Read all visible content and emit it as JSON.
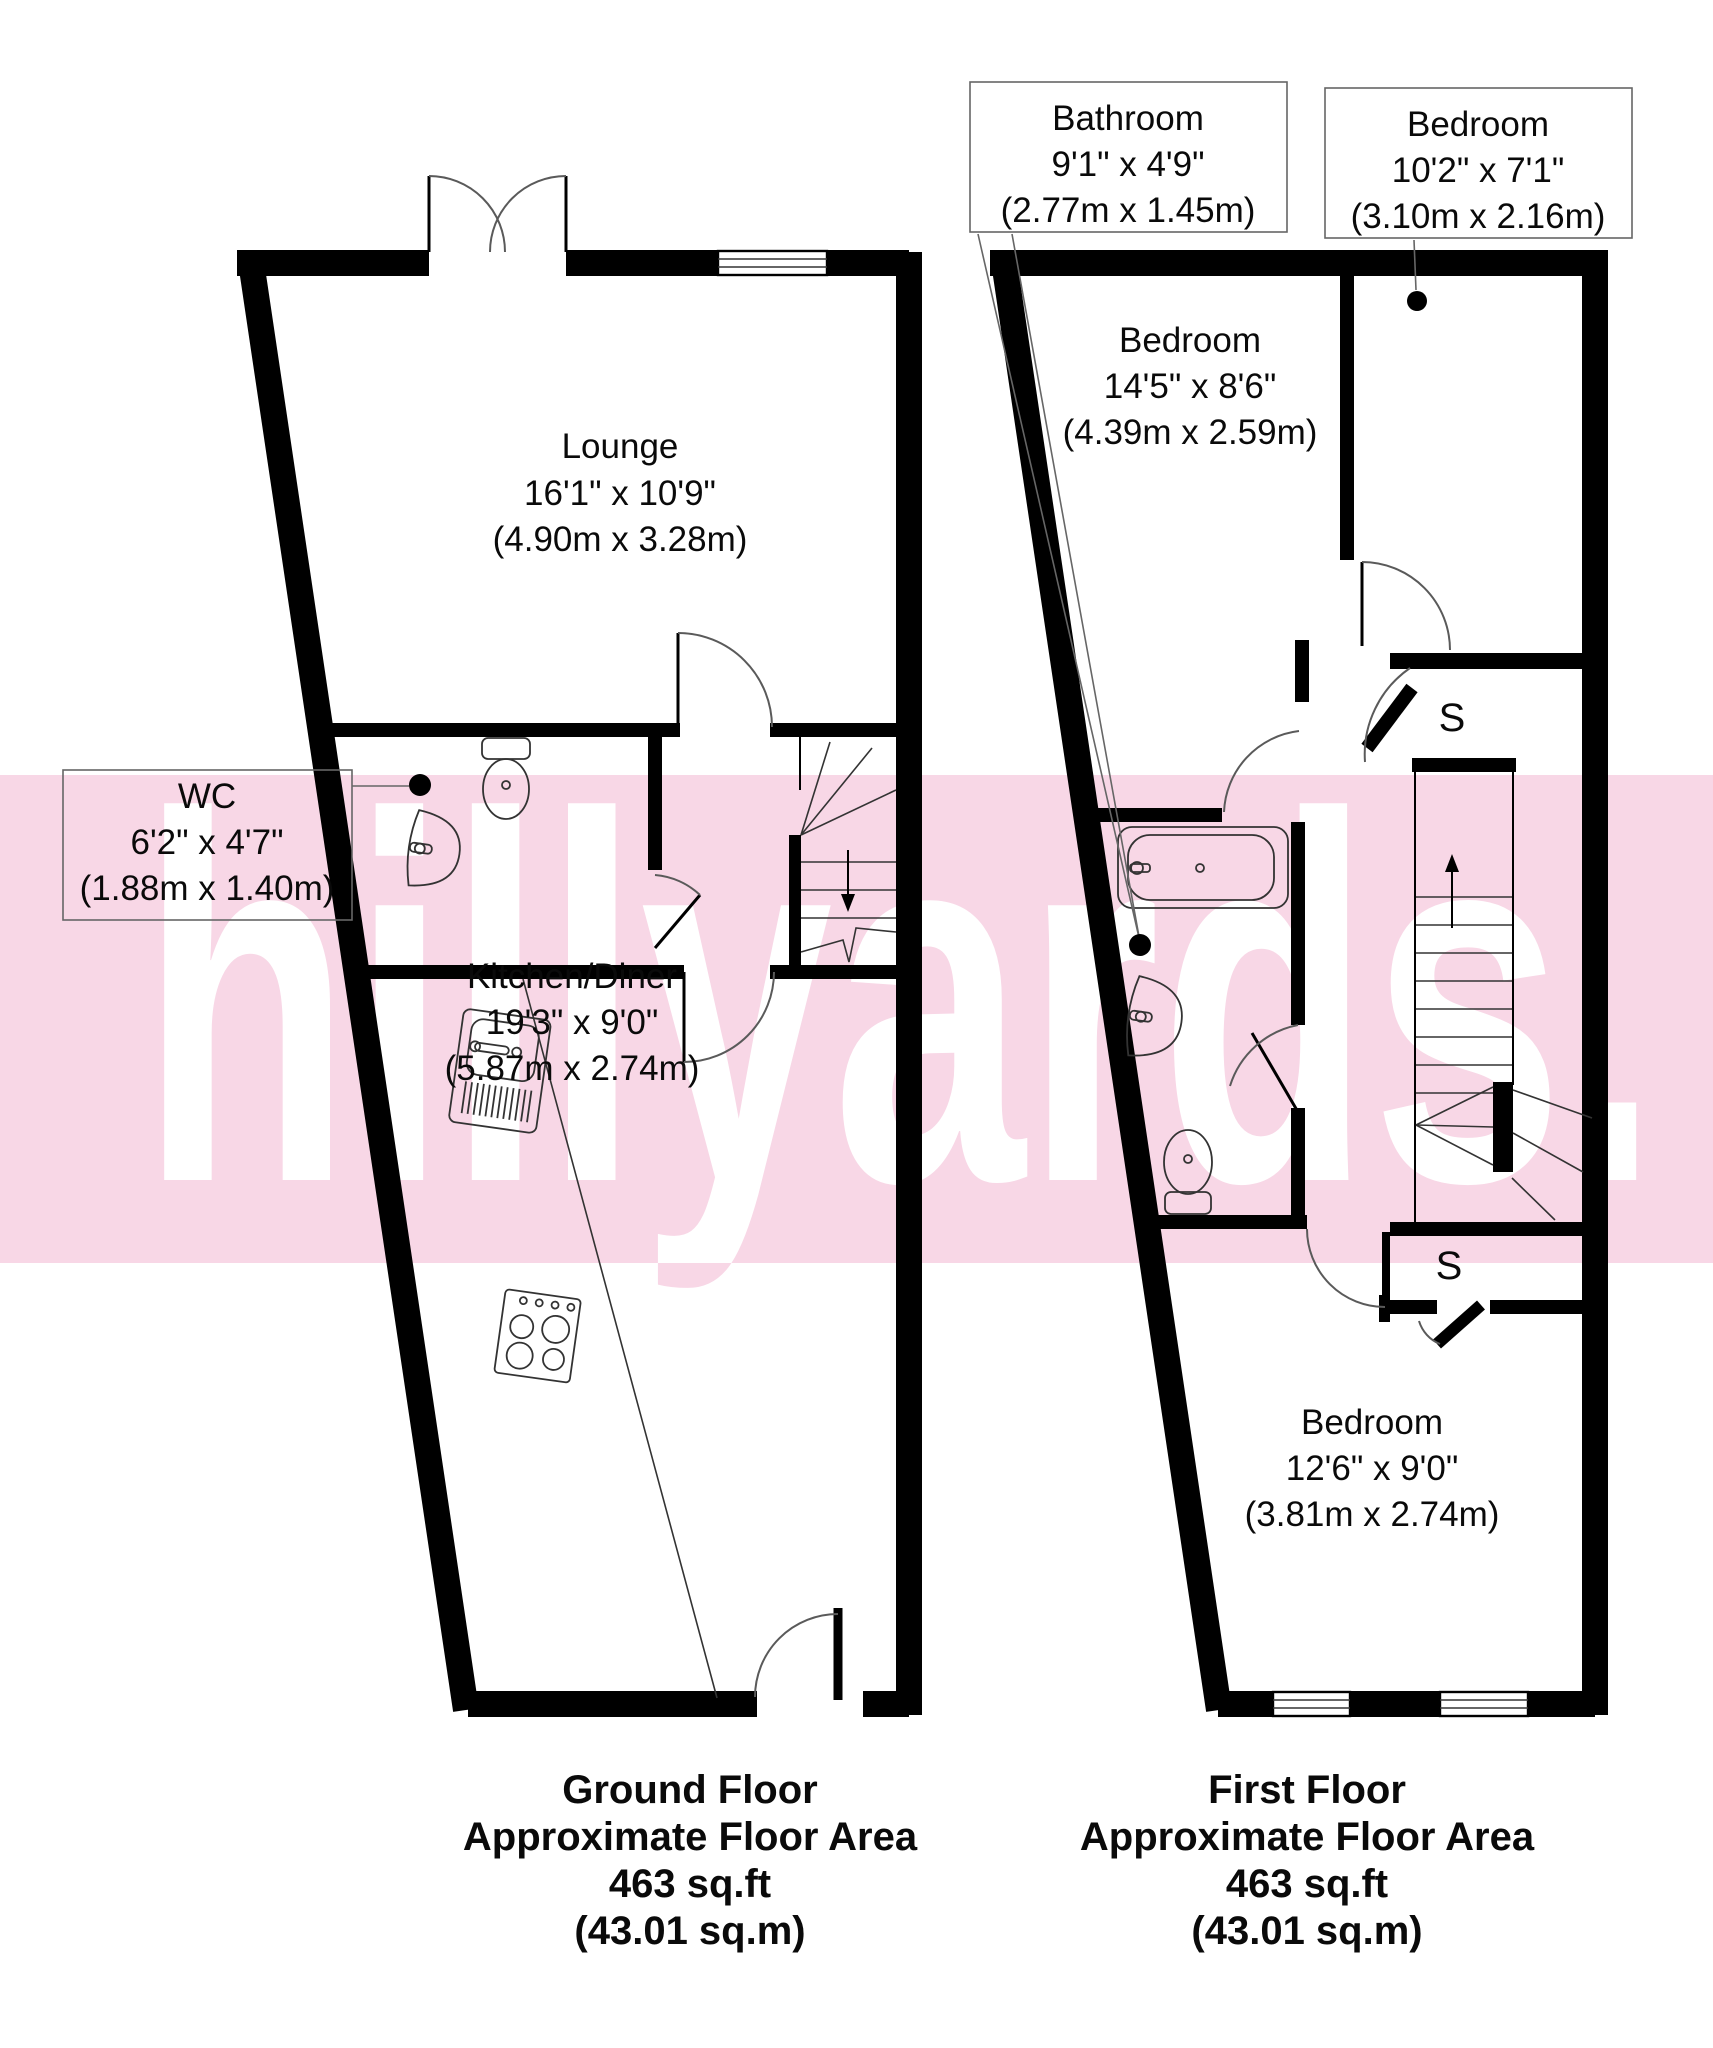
{
  "watermark": {
    "text": "hillyards.",
    "band_color": "#f8d7e6",
    "text_color": "#ffffff"
  },
  "ground_floor": {
    "rooms": {
      "lounge": {
        "name": "Lounge",
        "dims_ft": "16'1\" x 10'9\"",
        "dims_m": "(4.90m x 3.28m)"
      },
      "wc": {
        "name": "WC",
        "dims_ft": "6'2\" x 4'7\"",
        "dims_m": "(1.88m x 1.40m)"
      },
      "kitchen": {
        "name": "Kitchen/Diner",
        "dims_ft": "19'3\" x 9'0\"",
        "dims_m": "(5.87m x 2.74m)"
      }
    },
    "footer": {
      "line1": "Ground Floor",
      "line2": "Approximate Floor Area",
      "line3": "463 sq.ft",
      "line4": "(43.01 sq.m)"
    }
  },
  "first_floor": {
    "rooms": {
      "bathroom": {
        "name": "Bathroom",
        "dims_ft": "9'1\" x 4'9\"",
        "dims_m": "(2.77m x 1.45m)"
      },
      "bedroom_small": {
        "name": "Bedroom",
        "dims_ft": "10'2\" x 7'1\"",
        "dims_m": "(3.10m x 2.16m)"
      },
      "bedroom_large": {
        "name": "Bedroom",
        "dims_ft": "14'5\" x 8'6\"",
        "dims_m": "(4.39m x 2.59m)"
      },
      "bedroom_third": {
        "name": "Bedroom",
        "dims_ft": "12'6\" x 9'0\"",
        "dims_m": "(3.81m x 2.74m)"
      },
      "storage1": "S",
      "storage2": "S"
    },
    "footer": {
      "line1": "First Floor",
      "line2": "Approximate Floor Area",
      "line3": "463 sq.ft",
      "line4": "(43.01 sq.m)"
    }
  }
}
